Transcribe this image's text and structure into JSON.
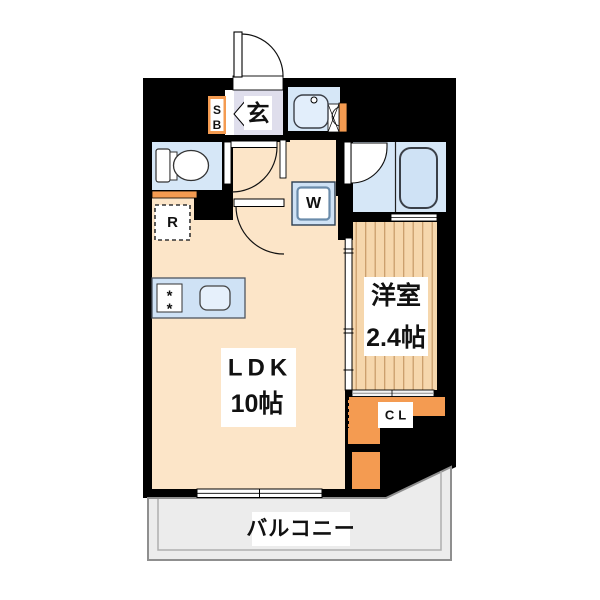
{
  "palette": {
    "wall": "#000000",
    "floor": "#fce5c8",
    "wet": "#d6e7f7",
    "counter": "#cfe2f5",
    "genkan": "#dfdeec",
    "wood": "#f6d7ad",
    "woodStripe": "#c79a67",
    "orange": "#f49b51",
    "balcony": "#ececec",
    "labelBg": "#ffffff",
    "text": "#111111"
  },
  "rooms": {
    "ldk": {
      "name": "LDK",
      "size": "10帖"
    },
    "western": {
      "name": "洋室",
      "size": "2.4帖"
    },
    "entrance": {
      "name": "玄"
    },
    "balcony": {
      "name": "バルコニー"
    }
  },
  "fixtures": {
    "shoe_box_line1": "S",
    "shoe_box_line2": "B",
    "washing_machine": "W",
    "refrigerator": "R",
    "closet": "CL",
    "burner_glyph": "*"
  }
}
